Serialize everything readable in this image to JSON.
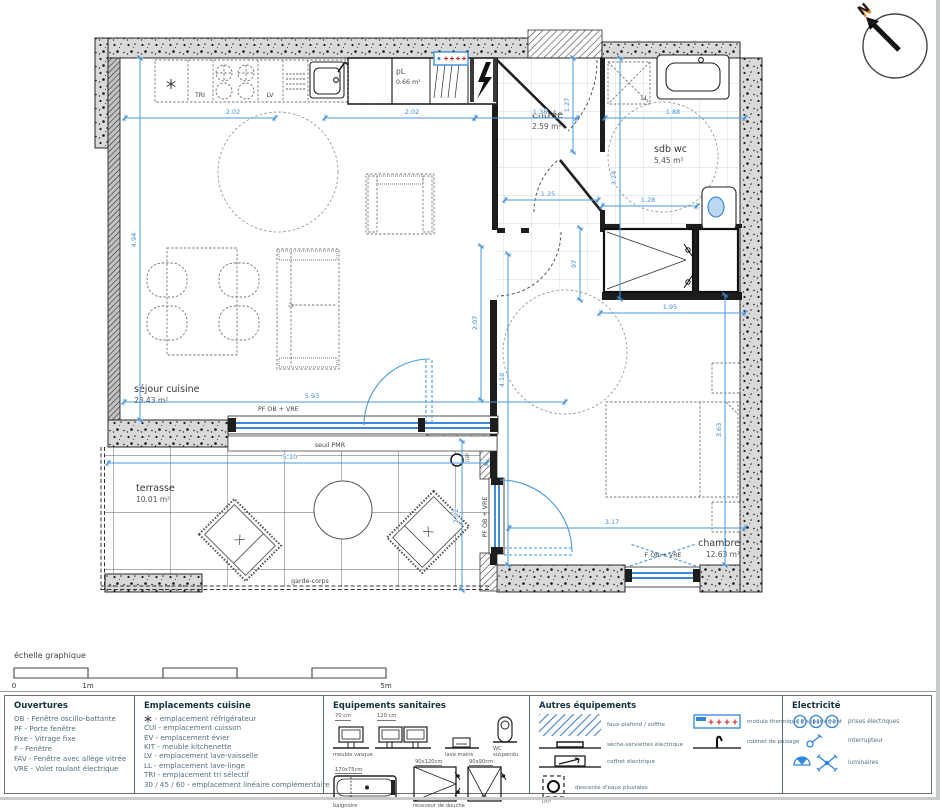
{
  "colors": {
    "dimension_blue": "#4a9ae0",
    "window_blue": "#2277dd",
    "hatch_blue": "#4a7fd0",
    "electric_blue": "#2e86de",
    "accent_red": "#cc2222",
    "north_orange": "#e8821e",
    "wall_gray": "#d9d9d9",
    "legend_title": "#14333f",
    "legend_text": "#53707c"
  },
  "north": {
    "label": "N"
  },
  "rooms": {
    "sejour": {
      "name": "séjour cuisine",
      "area": "23.43 m²"
    },
    "pl": {
      "name": "pL",
      "area": "0.66 m²"
    },
    "entree": {
      "name": "entrée",
      "area": "2.59 m²"
    },
    "sdb": {
      "name": "sdb wc",
      "area": "5.45 m²"
    },
    "chambre": {
      "name": "chambre",
      "area": "12.63 m²"
    },
    "terrasse": {
      "name": "terrasse",
      "area": "10.01 m²"
    }
  },
  "plan_labels": {
    "tri": "TRI",
    "lv": "LV",
    "ll": "LL",
    "window_sejour": "PF OB + VRE",
    "window_chambre_left": "PF OB + VRE",
    "window_chambre_bottom": "F OB + VRE",
    "seuil_pmr": "seuil PMR",
    "garde_corps": "garde-corps",
    "dep": "DEP"
  },
  "dims": {
    "kitchen_a": "2.02",
    "kitchen_b": "2.02",
    "entree_top": "1.38",
    "sdb_top": "1.88",
    "entree_w": "1.25",
    "sdb_w2": "1.28",
    "entree_v": "1.27",
    "entree_d": "97",
    "sdb_v": "3.24",
    "sejour_v": "4.94",
    "sejour_w": "5.93",
    "terrasse_w": "5.10",
    "terrasse_v": "2.02",
    "corridor_v": "2.07",
    "hall_v": "4.18",
    "sdb_low": "1.95",
    "chambre_w": "3.17",
    "chambre_v": "3.63"
  },
  "scale_bar": {
    "title": "échelle graphique",
    "t0": "0",
    "t1": "1m",
    "t5": "5m"
  },
  "legend": {
    "ouvertures": {
      "title": "Ouvertures",
      "items": [
        "OB - Fenêtre oscillo-battante",
        "PF - Porte fenêtre",
        "Fixe - Vitrage fixe",
        "F - Fenêtre",
        "FAV - Fenêtre avec allège vitrée",
        "VRE - Volet roulant électrique"
      ]
    },
    "cuisine": {
      "title": "Emplacements cuisine",
      "items": [
        "- emplacement réfrigérateur",
        "CUI - emplacement cuisson",
        "EV - emplacement évier",
        "KIT - meuble kitchenette",
        "LV - emplacement lave-vaisselle",
        "LL - emplacement lave-linge",
        "TRI - emplacement tri sélectif",
        "30 / 45 / 60 - emplacement linéaire complémentaire"
      ]
    },
    "sanitaires": {
      "title": "Equipements sanitaires",
      "labels": {
        "vasque_small": "70 cm",
        "vasque_large": "120 cm",
        "vasque": "meuble vasque",
        "lave_mains": "lave mains",
        "wc": "WC suspendu",
        "baignoire_dim": "170x75cm",
        "baignoire": "baignoire",
        "douche_dim1": "90x120cm",
        "douche_dim2": "90x90cm",
        "douche": "receveur de douche"
      }
    },
    "autres": {
      "title": "Autres équipements",
      "items": [
        "faux-plafond / soffite",
        "sèche-serviettes électrique",
        "coffret électrique",
        "descente d'eaux pluviales",
        "module thermique d'appartement",
        "robinet de puisage"
      ],
      "dep": "DEP"
    },
    "electricite": {
      "title": "Electricité",
      "items": [
        "prises électriques",
        "interrupteur",
        "luminaires"
      ]
    }
  }
}
